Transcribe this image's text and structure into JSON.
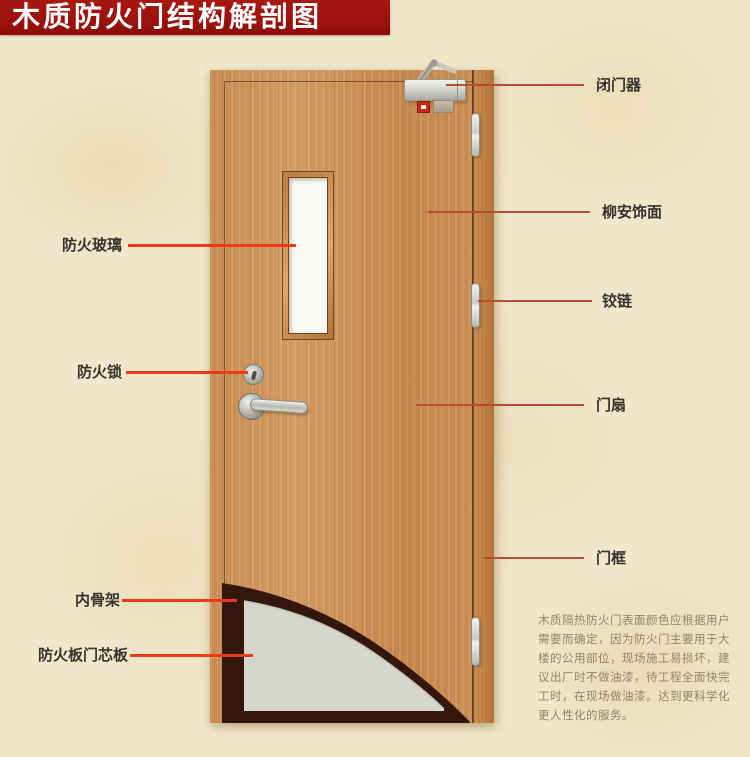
{
  "title": "木质防火门结构解剖图",
  "labels": {
    "left": [
      {
        "text": "防火玻璃"
      },
      {
        "text": "防火锁"
      },
      {
        "text": "内骨架"
      },
      {
        "text": "防火板门芯板"
      }
    ],
    "right": [
      {
        "text": "闭门器"
      },
      {
        "text": "柳安饰面"
      },
      {
        "text": "铰链"
      },
      {
        "text": "门扇"
      },
      {
        "text": "门框"
      }
    ]
  },
  "description": "木质隔热防火门表面颜色应根据用户\n需要而确定，因为防火门主要用于大\n楼的公用部位，现场施工易损坏，建\n议出厂时不做油漆，待工程全面快完\n工时，在现场做油漆。达到更科学化\n更人性化的服务。",
  "colors": {
    "banner_red": "#9c110c",
    "left_line_red": "#ee3b17",
    "right_line_red": "#b34d33",
    "door_wood": "#c99259",
    "frame_wood": "#bd7e44",
    "glass_white": "#fbfbf6",
    "core_gray": "#d6d6cd",
    "skeleton_dark_brown": "#33170b",
    "background_parchment": "#f1e8cc"
  }
}
